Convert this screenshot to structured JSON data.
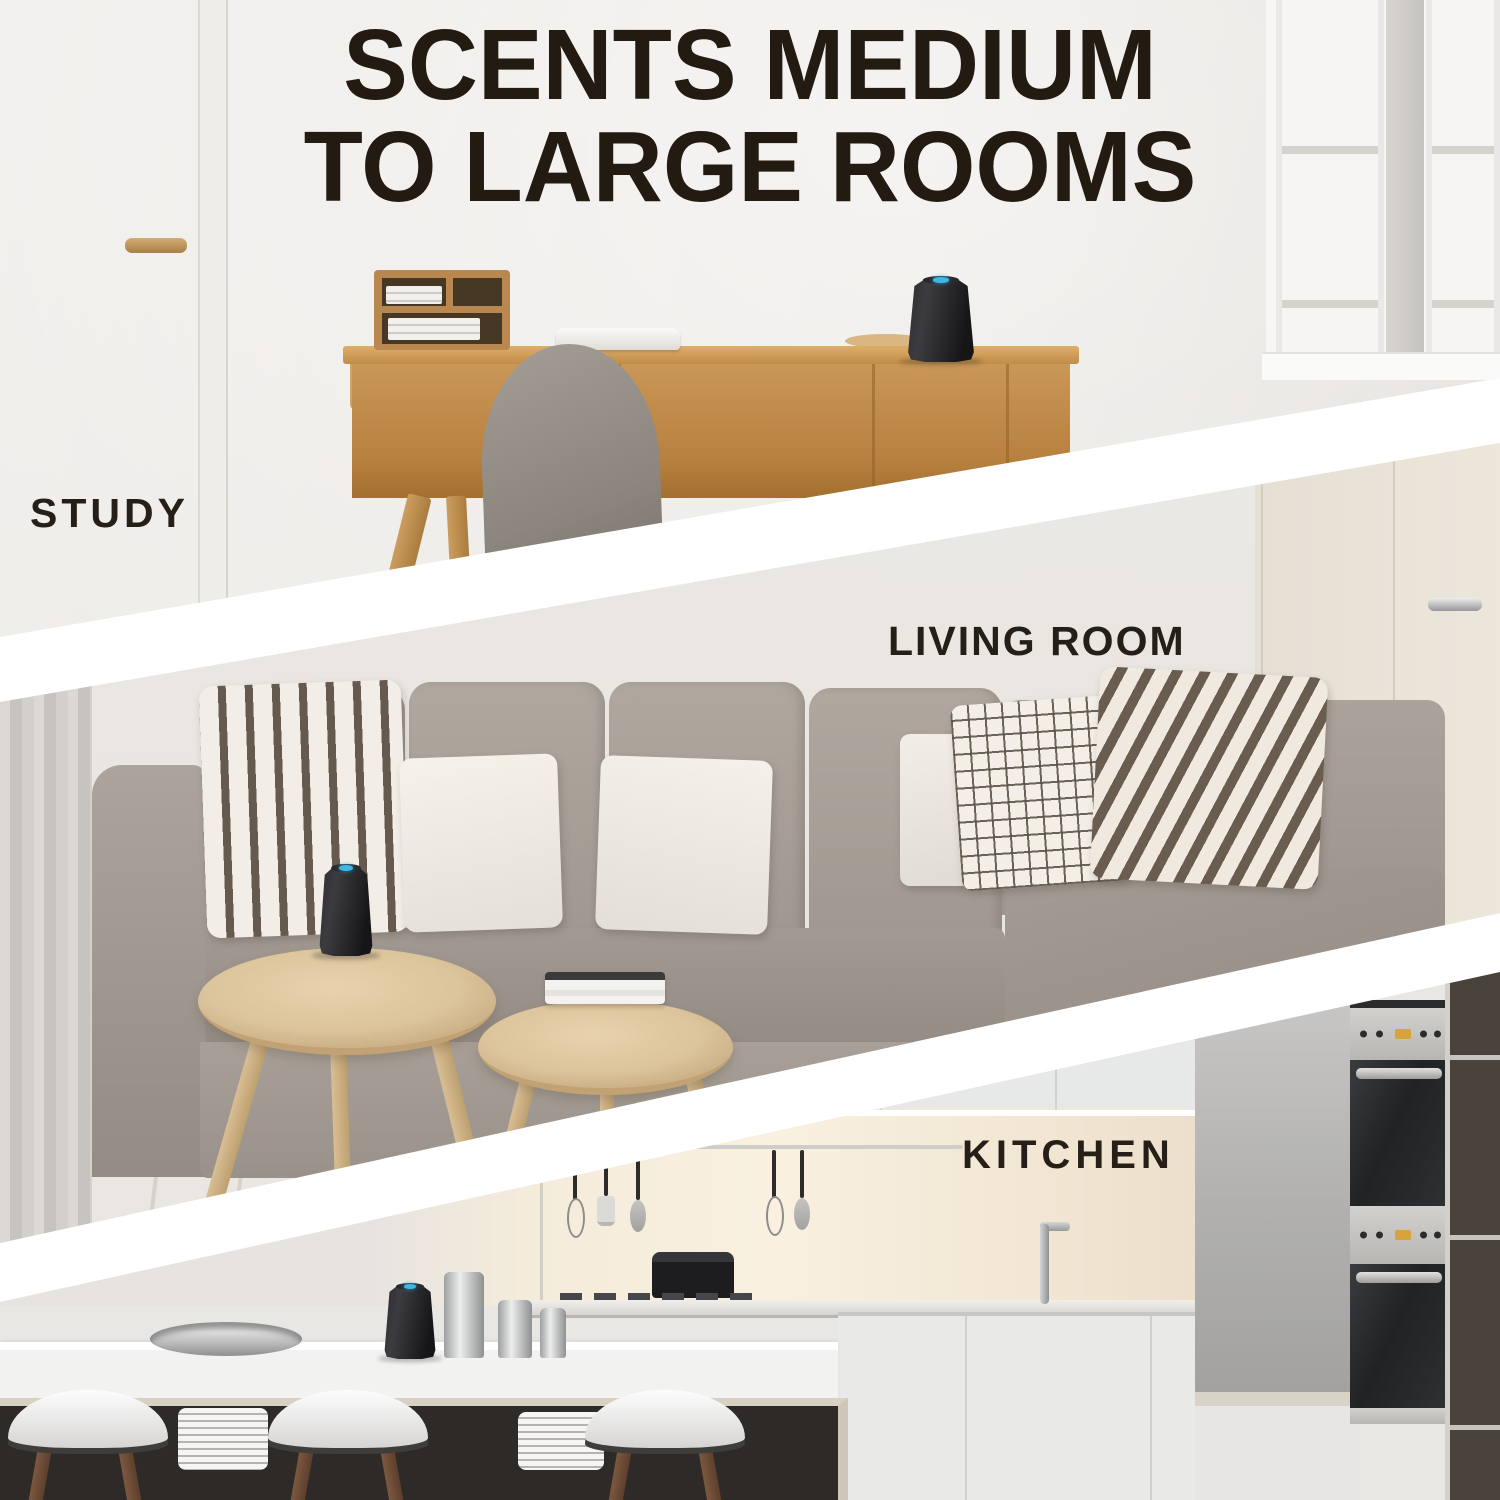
{
  "headline": {
    "line1": "SCENTS MEDIUM",
    "line2": "TO LARGE ROOMS"
  },
  "rooms": [
    {
      "id": "study",
      "label": "STUDY"
    },
    {
      "id": "living-room",
      "label": "LIVING ROOM"
    },
    {
      "id": "kitchen",
      "label": "KITCHEN"
    }
  ],
  "product": {
    "body_color": "#1c1c1f",
    "indicator_color": "#3db7e4",
    "placements": [
      "study-desk",
      "living-room-coffee-table",
      "kitchen-counter"
    ]
  },
  "colors": {
    "headline_text": "#231a12",
    "label_text": "#261f18",
    "divider_stripe": "#ffffff",
    "desk_wood": "#c08c4a",
    "sofa_gray": "#a29a92",
    "table_wood": "#dcc49c"
  }
}
